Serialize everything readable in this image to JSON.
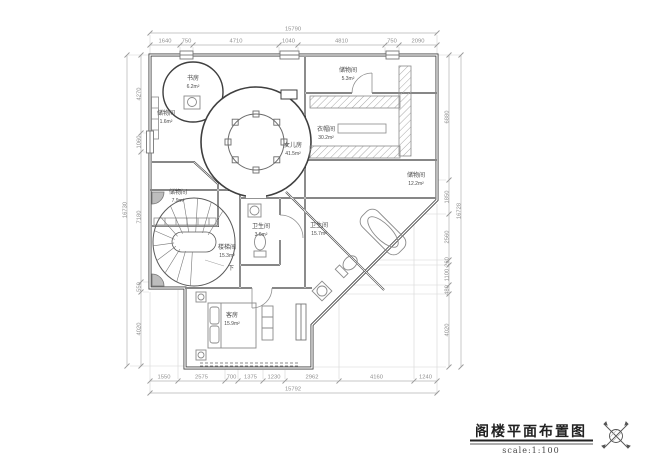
{
  "drawing": {
    "title": "阁楼平面布置图",
    "scale_label": "scale:1:100"
  },
  "dimensions": {
    "top_total": "15790",
    "top_segments": [
      "1640",
      "750",
      "4710",
      "1040",
      "4810",
      "750",
      "2090"
    ],
    "bottom_segments": [
      "1550",
      "2575",
      "700",
      "1375",
      "1230",
      "2962",
      "4160",
      "1240"
    ],
    "bottom_total": "15792",
    "left_total": "16730",
    "left_segments": [
      "4270",
      "1060",
      "7180",
      "550",
      "4020"
    ],
    "right_segments": [
      "6880",
      "1850",
      "2560",
      "260",
      "1100",
      "480",
      "4020"
    ],
    "right_total": "16728"
  },
  "rooms": [
    {
      "name": "书房",
      "area": "6.2m²"
    },
    {
      "name": "储物间",
      "area": "5.3m²"
    },
    {
      "name": "储物间",
      "area": "1.6m²"
    },
    {
      "name": "衣帽间",
      "area": "30.2m²"
    },
    {
      "name": "女儿房",
      "area": "41.5m²"
    },
    {
      "name": "储物间",
      "area": "12.2m²"
    },
    {
      "name": "储物间",
      "area": "7.9m²"
    },
    {
      "name": "楼梯间",
      "area": "15.3m²"
    },
    {
      "name": "卫生间",
      "area": "3.6m²"
    },
    {
      "name": "卫生间",
      "area": "15.7m²"
    },
    {
      "name": "客房",
      "area": "15.9m²"
    }
  ],
  "annotations": {
    "stairs_down": "下"
  },
  "colors": {
    "wall": "#3f3f3f",
    "dimension": "#9a9a9a",
    "background": "#ffffff"
  }
}
